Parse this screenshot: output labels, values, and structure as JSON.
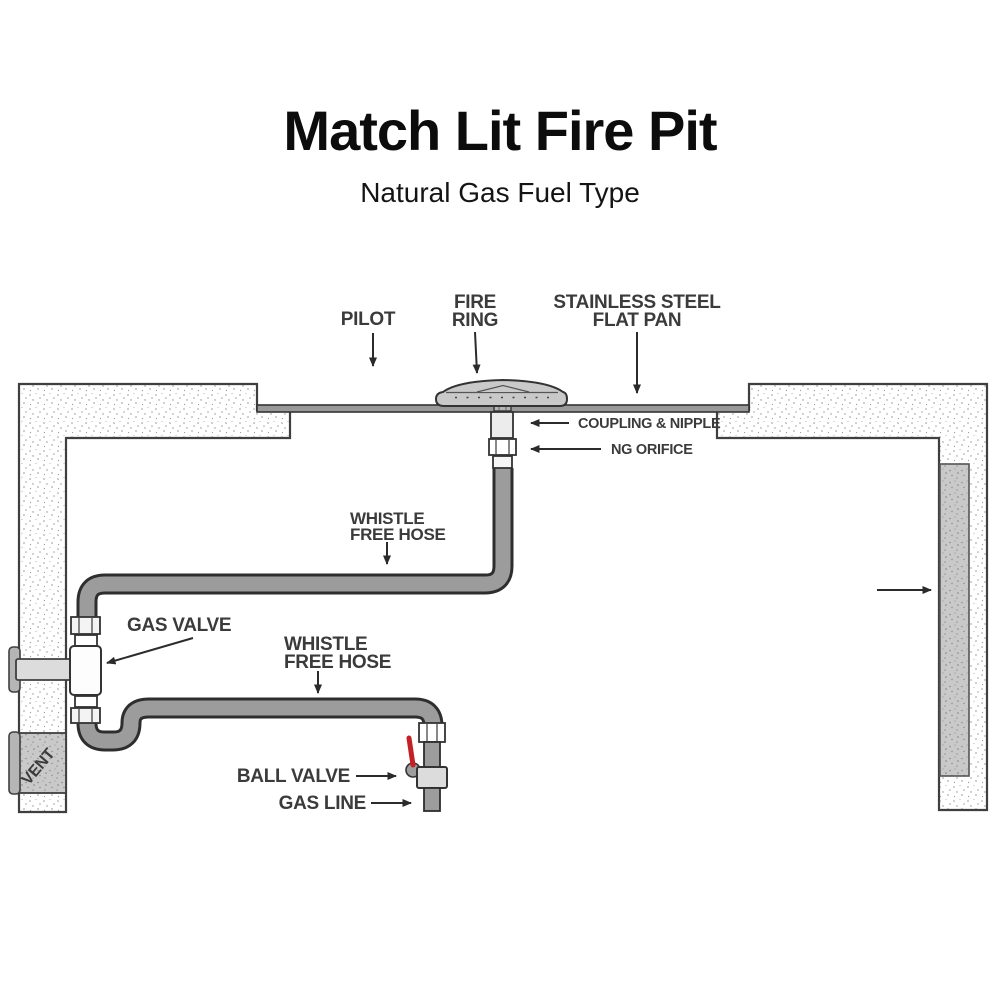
{
  "header": {
    "title": "Match Lit Fire Pit",
    "subtitle": "Natural Gas Fuel Type"
  },
  "labels": {
    "pilot": "PILOT",
    "fire_ring": [
      "FIRE",
      "RING"
    ],
    "flat_pan": [
      "STAINLESS STEEL",
      "FLAT PAN"
    ],
    "coupling_nipple": "COUPLING & NIPPLE",
    "ng_orifice": "NG ORIFICE",
    "whistle_hose_upper": [
      "WHISTLE",
      "FREE HOSE"
    ],
    "gas_valve": "GAS VALVE",
    "whistle_hose_lower": [
      "WHISTLE",
      "FREE HOSE"
    ],
    "ball_valve": "BALL VALVE",
    "gas_line": "GAS LINE",
    "vent": "VENT"
  },
  "colors": {
    "label_text": "#3b3b3b",
    "outline": "#3f3f3f",
    "hose_fill": "#9c9c9c",
    "hose_outline": "#2e2e2e",
    "ring_fill": "#c9c9c9",
    "pan_fill": "#999999",
    "vent_fill": "#c9c9c9",
    "wall_inner_panel": "#cdcdcd",
    "valve_handle_red": "#c42127"
  }
}
